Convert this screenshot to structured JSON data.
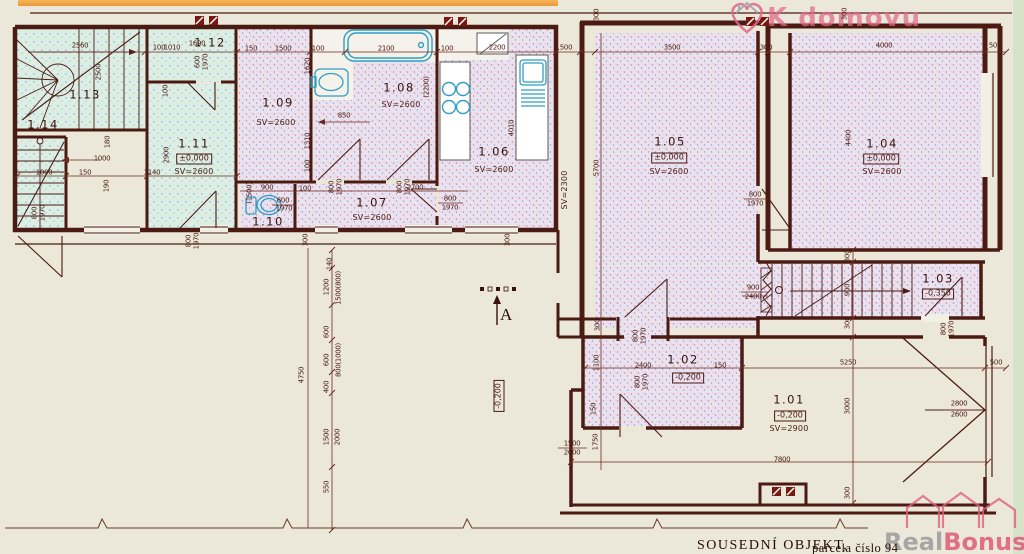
{
  "plan": {
    "section_label": "A"
  },
  "watermarks": {
    "top": "K domovu",
    "bottom_real": "Real",
    "bottom_bonus": "Bonus",
    "bottom_cz": ".cz"
  },
  "footer": {
    "neighbor": "SOUSEDNÍ OBJEKT,",
    "parcel": "parcela číslo 94"
  },
  "colors": {
    "wall": "#4b1b13",
    "dimension": "#6d2a1e",
    "fixture": "#2f9ec2",
    "fill_pink": "#eae2ef",
    "fill_cyan": "#dceee5",
    "watermark_pink": "#e0607c"
  },
  "rooms": [
    {
      "label": "1.13",
      "lx": 85,
      "ly": 95
    },
    {
      "label": "1.12",
      "lx": 210,
      "ly": 43
    },
    {
      "label": "1.11",
      "level": "±0,000",
      "sv": "SV=2600",
      "lx": 194,
      "ly": 144,
      "vx": 194,
      "vy": 159,
      "sx": 194,
      "sy": 172
    },
    {
      "label": "1.14",
      "lx": 43,
      "ly": 125
    },
    {
      "label": "1.09",
      "sv": "SV=2600",
      "lx": 278,
      "ly": 103,
      "sx": 276,
      "sy": 123
    },
    {
      "label": "1.08",
      "sv": "SV=2600",
      "lx": 399,
      "ly": 88,
      "sx": 401,
      "sy": 105
    },
    {
      "label": "1.10",
      "lx": 268,
      "ly": 222
    },
    {
      "label": "1.07",
      "sv": "SV=2600",
      "lx": 372,
      "ly": 203,
      "sx": 372,
      "sy": 218
    },
    {
      "label": "1.06",
      "sv": "SV=2600",
      "lx": 494,
      "ly": 152,
      "sx": 494,
      "sy": 170
    },
    {
      "label": "1.05",
      "level": "±0,000",
      "sv": "SV=2600",
      "lx": 670,
      "ly": 142,
      "vx": 669,
      "vy": 158,
      "sx": 669,
      "sy": 172
    },
    {
      "label": "1.04",
      "level": "±0,000",
      "sv": "SV=2600",
      "lx": 882,
      "ly": 144,
      "vx": 881,
      "vy": 159,
      "sx": 882,
      "sy": 172
    },
    {
      "label": "1.03",
      "level": "-0,350",
      "lx": 938,
      "ly": 279,
      "vx": 938,
      "vy": 294
    },
    {
      "label": "1.02",
      "level": "-0,200",
      "lx": 683,
      "ly": 360,
      "vx": 688,
      "vy": 378
    },
    {
      "label": "1.01",
      "level": "-0,200",
      "sv": "SV=2900",
      "lx": 789,
      "ly": 400,
      "vx": 790,
      "vy": 416,
      "sx": 789,
      "sy": 429
    }
  ],
  "annotations": [
    {
      "t": "2560",
      "x": 80,
      "y": 46
    },
    {
      "t": "2500",
      "x": 99,
      "y": 72,
      "v": 1
    },
    {
      "t": "1690",
      "x": 197,
      "y": 44
    },
    {
      "t": "100",
      "x": 159,
      "y": 48
    },
    {
      "t": "1010",
      "x": 172,
      "y": 48
    },
    {
      "t": "600",
      "x": 198,
      "y": 62,
      "v": 1
    },
    {
      "t": "1970",
      "x": 206,
      "y": 62,
      "v": 1
    },
    {
      "t": "100",
      "x": 166,
      "y": 91,
      "v": 1
    },
    {
      "t": "2900",
      "x": 167,
      "y": 155,
      "v": 1
    },
    {
      "t": "1000",
      "x": 44,
      "y": 173
    },
    {
      "t": "150",
      "x": 85,
      "y": 173
    },
    {
      "t": "3140",
      "x": 152,
      "y": 173
    },
    {
      "t": "1000",
      "x": 102,
      "y": 159
    },
    {
      "t": "180",
      "x": 108,
      "y": 142,
      "v": 1
    },
    {
      "t": "190",
      "x": 107,
      "y": 186,
      "v": 1
    },
    {
      "t": "800",
      "x": 35,
      "y": 213,
      "v": 1
    },
    {
      "t": "1970",
      "x": 43,
      "y": 213,
      "v": 1
    },
    {
      "t": "800",
      "x": 189,
      "y": 241,
      "v": 1
    },
    {
      "t": "1970",
      "x": 197,
      "y": 241,
      "v": 1
    },
    {
      "t": "150",
      "x": 251,
      "y": 49
    },
    {
      "t": "1500",
      "x": 283,
      "y": 49
    },
    {
      "t": "100",
      "x": 318,
      "y": 49
    },
    {
      "t": "2100",
      "x": 386,
      "y": 49
    },
    {
      "t": "100",
      "x": 447,
      "y": 49
    },
    {
      "t": "2200",
      "x": 497,
      "y": 48
    },
    {
      "t": "500",
      "x": 566,
      "y": 48
    },
    {
      "t": "3500",
      "x": 672,
      "y": 48
    },
    {
      "t": "300",
      "x": 766,
      "y": 48
    },
    {
      "t": "4000",
      "x": 884,
      "y": 46
    },
    {
      "t": "500",
      "x": 995,
      "y": 46
    },
    {
      "t": "1620",
      "x": 308,
      "y": 66,
      "v": 1
    },
    {
      "t": "(2200)",
      "x": 427,
      "y": 87,
      "v": 1
    },
    {
      "t": "850",
      "x": 344,
      "y": 116
    },
    {
      "t": "1310",
      "x": 308,
      "y": 141,
      "v": 1
    },
    {
      "t": "100",
      "x": 308,
      "y": 166,
      "v": 1
    },
    {
      "t": "(1500)",
      "x": 250,
      "y": 193,
      "v": 1
    },
    {
      "t": "900",
      "x": 267,
      "y": 188
    },
    {
      "t": "600",
      "x": 283,
      "y": 201
    },
    {
      "t": "1970",
      "x": 284,
      "y": 209
    },
    {
      "t": "100",
      "x": 305,
      "y": 189
    },
    {
      "t": "800",
      "x": 332,
      "y": 187,
      "v": 1
    },
    {
      "t": "1970",
      "x": 340,
      "y": 187,
      "v": 1
    },
    {
      "t": "2700",
      "x": 415,
      "y": 188
    },
    {
      "t": "800",
      "x": 400,
      "y": 187,
      "v": 1
    },
    {
      "t": "1970",
      "x": 408,
      "y": 187,
      "v": 1
    },
    {
      "t": "800",
      "x": 450,
      "y": 199
    },
    {
      "t": "1970",
      "x": 450,
      "y": 208
    },
    {
      "t": "4010",
      "x": 512,
      "y": 128,
      "v": 1
    },
    {
      "t": "SV=2300",
      "x": 565,
      "y": 190,
      "v": 1,
      "c": "sv"
    },
    {
      "t": "5700",
      "x": 597,
      "y": 168,
      "v": 1
    },
    {
      "t": "300",
      "x": 597,
      "y": 15,
      "v": 1
    },
    {
      "t": "300",
      "x": 845,
      "y": 14,
      "v": 1
    },
    {
      "t": "4400",
      "x": 849,
      "y": 138,
      "v": 1
    },
    {
      "t": "800",
      "x": 755,
      "y": 195
    },
    {
      "t": "1970",
      "x": 755,
      "y": 204
    },
    {
      "t": "900",
      "x": 753,
      "y": 288
    },
    {
      "t": "2400",
      "x": 753,
      "y": 297
    },
    {
      "t": "300",
      "x": 848,
      "y": 256,
      "v": 1
    },
    {
      "t": "900",
      "x": 848,
      "y": 290,
      "v": 1
    },
    {
      "t": "300",
      "x": 848,
      "y": 323,
      "v": 1
    },
    {
      "t": "800",
      "x": 944,
      "y": 329,
      "v": 1
    },
    {
      "t": "1970",
      "x": 952,
      "y": 329,
      "v": 1
    },
    {
      "t": "5250",
      "x": 848,
      "y": 363
    },
    {
      "t": "500",
      "x": 996,
      "y": 363
    },
    {
      "t": "3000",
      "x": 848,
      "y": 406,
      "v": 1
    },
    {
      "t": "2800",
      "x": 959,
      "y": 404
    },
    {
      "t": "2600",
      "x": 959,
      "y": 415
    },
    {
      "t": "300",
      "x": 848,
      "y": 493,
      "v": 1
    },
    {
      "t": "300",
      "x": 598,
      "y": 325,
      "v": 1
    },
    {
      "t": "800",
      "x": 636,
      "y": 336,
      "v": 1
    },
    {
      "t": "1970",
      "x": 644,
      "y": 336,
      "v": 1
    },
    {
      "t": "1100",
      "x": 597,
      "y": 363,
      "v": 1
    },
    {
      "t": "2400",
      "x": 643,
      "y": 366
    },
    {
      "t": "150",
      "x": 720,
      "y": 366
    },
    {
      "t": "800",
      "x": 638,
      "y": 382,
      "v": 1
    },
    {
      "t": "1970",
      "x": 646,
      "y": 382,
      "v": 1
    },
    {
      "t": "150",
      "x": 594,
      "y": 409,
      "v": 1
    },
    {
      "t": "1500",
      "x": 572,
      "y": 444
    },
    {
      "t": "2000",
      "x": 572,
      "y": 453
    },
    {
      "t": "1750",
      "x": 596,
      "y": 442,
      "v": 1
    },
    {
      "t": "7800",
      "x": 782,
      "y": 460
    },
    {
      "t": "140",
      "x": 330,
      "y": 264,
      "v": 1
    },
    {
      "t": "1200",
      "x": 327,
      "y": 287,
      "v": 1
    },
    {
      "t": "1500(800)",
      "x": 339,
      "y": 288,
      "v": 1
    },
    {
      "t": "600",
      "x": 327,
      "y": 332,
      "v": 1
    },
    {
      "t": "600",
      "x": 327,
      "y": 360,
      "v": 1
    },
    {
      "t": "800(1000)",
      "x": 339,
      "y": 360,
      "v": 1
    },
    {
      "t": "400",
      "x": 327,
      "y": 387,
      "v": 1
    },
    {
      "t": "1500",
      "x": 327,
      "y": 437,
      "v": 1
    },
    {
      "t": "2000",
      "x": 338,
      "y": 437,
      "v": 1
    },
    {
      "t": "550",
      "x": 327,
      "y": 487,
      "v": 1
    },
    {
      "t": "4750",
      "x": 302,
      "y": 375,
      "v": 1
    },
    {
      "t": "300",
      "x": 306,
      "y": 240,
      "v": 1
    },
    {
      "t": "300",
      "x": 508,
      "y": 240,
      "v": 1
    },
    {
      "t": "-0,200",
      "x": 499,
      "y": 396,
      "v": 1,
      "c": "lvl"
    }
  ]
}
